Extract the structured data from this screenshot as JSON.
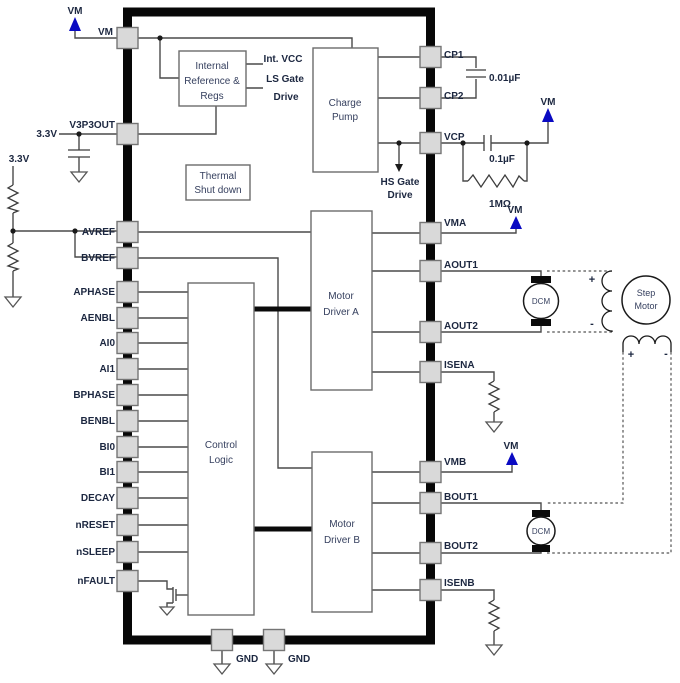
{
  "labels": {
    "vm": "VM",
    "v33": "3.3V",
    "gnd": "GND",
    "plus": "+",
    "minus": "-",
    "cap_cp": "0.01µF",
    "cap_vcp": "0.1µF",
    "res_vcp": "1MΩ",
    "int_vcc": "Int. VCC",
    "ls_gate_1": "LS Gate",
    "ls_gate_2": "Drive",
    "hs_gate_1": "HS Gate",
    "hs_gate_2": "Drive",
    "dcm": "DCM",
    "step_1": "Step",
    "step_2": "Motor"
  },
  "blocks": {
    "internal_ref": [
      "Internal",
      "Reference &",
      "Regs"
    ],
    "charge_pump": [
      "Charge",
      "Pump"
    ],
    "thermal": [
      "Thermal",
      "Shut down"
    ],
    "control": [
      "Control",
      "Logic"
    ],
    "driver_a": [
      "Motor",
      "Driver A"
    ],
    "driver_b": [
      "Motor",
      "Driver B"
    ]
  },
  "pins": {
    "left": [
      "VM",
      "V3P3OUT",
      "AVREF",
      "BVREF",
      "APHASE",
      "AENBL",
      "AI0",
      "AI1",
      "BPHASE",
      "BENBL",
      "BI0",
      "BI1",
      "DECAY",
      "nRESET",
      "nSLEEP",
      "nFAULT"
    ],
    "right": [
      "CP1",
      "CP2",
      "VCP",
      "VMA",
      "AOUT1",
      "AOUT2",
      "ISENA",
      "VMB",
      "BOUT1",
      "BOUT2",
      "ISENB"
    ],
    "bottom": [
      "GND",
      "GND"
    ]
  }
}
